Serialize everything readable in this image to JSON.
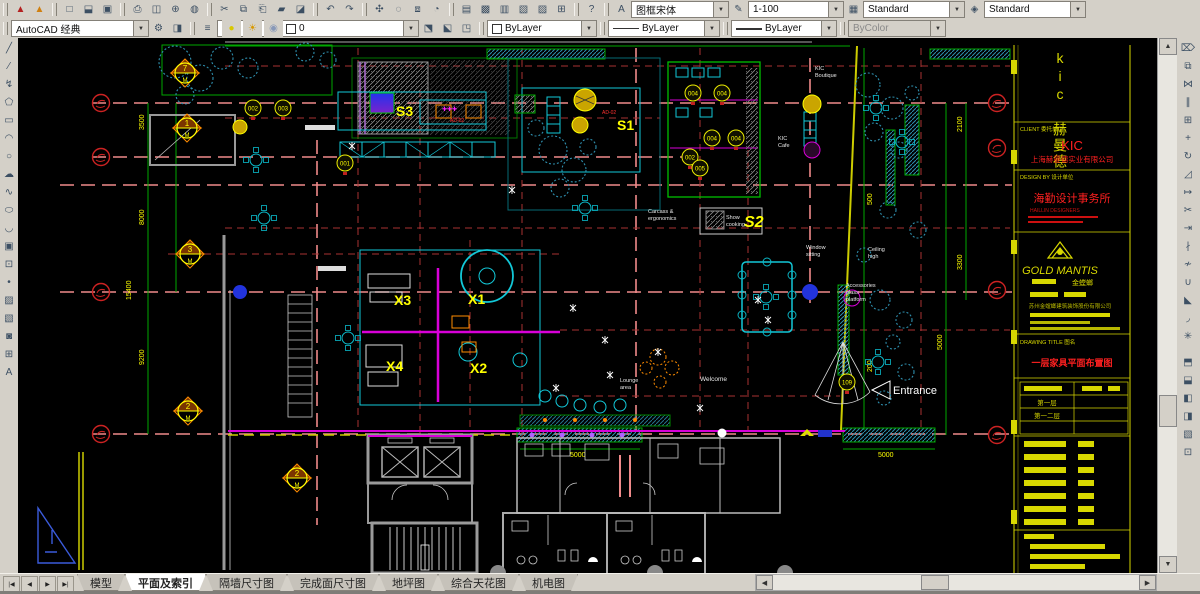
{
  "toolbars": {
    "row1_icons": [
      {
        "n": "pdf-export-icon",
        "g": "▲",
        "c": "#b42020"
      },
      {
        "n": "pdf-convert-icon",
        "g": "▲",
        "c": "#d08010"
      },
      {
        "n": "sep"
      },
      {
        "n": "new-file-icon",
        "g": "□"
      },
      {
        "n": "open-file-icon",
        "g": "⬓"
      },
      {
        "n": "save-icon",
        "g": "▣"
      },
      {
        "n": "sep"
      },
      {
        "n": "plot-icon",
        "g": "⎙"
      },
      {
        "n": "plot-preview-icon",
        "g": "◫"
      },
      {
        "n": "publish-icon",
        "g": "⊕"
      },
      {
        "n": "dwf-viewer-icon",
        "g": "◍"
      },
      {
        "n": "sep"
      },
      {
        "n": "cut-icon",
        "g": "✂"
      },
      {
        "n": "copy-clip-icon",
        "g": "⧉"
      },
      {
        "n": "paste-icon",
        "g": "⎗"
      },
      {
        "n": "match-properties-icon",
        "g": "▰"
      },
      {
        "n": "block-editor-icon",
        "g": "◪"
      },
      {
        "n": "sep"
      },
      {
        "n": "undo-icon",
        "g": "↶"
      },
      {
        "n": "redo-icon",
        "g": "↷"
      },
      {
        "n": "sep"
      },
      {
        "n": "pan-icon",
        "g": "✣"
      },
      {
        "n": "zoom-realtime-icon",
        "g": "◌"
      },
      {
        "n": "zoom-window-icon",
        "g": "⧈"
      },
      {
        "n": "zoom-previous-icon",
        "g": "◔"
      },
      {
        "n": "sep"
      },
      {
        "n": "properties-icon",
        "g": "▤"
      },
      {
        "n": "designcenter-icon",
        "g": "▩"
      },
      {
        "n": "tool-palettes-icon",
        "g": "▥"
      },
      {
        "n": "sheetset-manager-icon",
        "g": "▧"
      },
      {
        "n": "markup-icon",
        "g": "▨"
      },
      {
        "n": "quickcalc-icon",
        "g": "⊞"
      },
      {
        "n": "sep"
      },
      {
        "n": "help-icon",
        "g": "?"
      },
      {
        "n": "sep"
      },
      {
        "n": "text-style-icon",
        "g": "A"
      }
    ],
    "text_style_value": "图框宋体",
    "dim_style_icon": "✎",
    "scale_value": "1-100",
    "table_style_icon": "▦",
    "dim_style_value": "Standard",
    "mleader_icon": "◈",
    "table_style_value": "Standard",
    "workspace_value": "AutoCAD 经典",
    "workspace_icons": [
      {
        "n": "workspace-settings-icon",
        "g": "⚙"
      },
      {
        "n": "workspace-save-icon",
        "g": "◨"
      }
    ],
    "layer_properties_icon": {
      "n": "layer-properties-icon",
      "g": "≡"
    },
    "layer_state_icons": [
      {
        "n": "lightbulb-icon",
        "g": "●",
        "c": "#d8c800"
      },
      {
        "n": "sun-icon",
        "g": "☀",
        "c": "#d89800"
      },
      {
        "n": "lock-icon",
        "g": "◉",
        "c": "#8898b8"
      }
    ],
    "layer_value": "0",
    "layer_right_icons": [
      {
        "n": "make-object-layer-current-icon",
        "g": "⬔"
      },
      {
        "n": "layer-previous-icon",
        "g": "⬕"
      },
      {
        "n": "layer-states-icon",
        "g": "◳"
      }
    ],
    "color_value": "ByLayer",
    "linetype_value": "ByLayer",
    "lineweight_value": "ByLayer",
    "plotstyle_value": "ByColor",
    "draw_icons": [
      {
        "n": "line-icon",
        "g": "╱"
      },
      {
        "n": "construction-line-icon",
        "g": "⁄"
      },
      {
        "n": "polyline-icon",
        "g": "↯"
      },
      {
        "n": "polygon-icon",
        "g": "⬠"
      },
      {
        "n": "rectangle-icon",
        "g": "▭"
      },
      {
        "n": "arc-icon",
        "g": "◠"
      },
      {
        "n": "circle-icon",
        "g": "○"
      },
      {
        "n": "revision-cloud-icon",
        "g": "☁"
      },
      {
        "n": "spline-icon",
        "g": "∿"
      },
      {
        "n": "ellipse-icon",
        "g": "⬭"
      },
      {
        "n": "ellipse-arc-icon",
        "g": "◡"
      },
      {
        "n": "insert-block-icon",
        "g": "▣"
      },
      {
        "n": "make-block-icon",
        "g": "⊡"
      },
      {
        "n": "point-icon",
        "g": "•"
      },
      {
        "n": "hatch-icon",
        "g": "▨"
      },
      {
        "n": "gradient-icon",
        "g": "▧"
      },
      {
        "n": "region-icon",
        "g": "◙"
      },
      {
        "n": "table-icon",
        "g": "⊞"
      },
      {
        "n": "mtext-icon",
        "g": "A"
      }
    ],
    "modify_icons": [
      {
        "n": "erase-icon",
        "g": "⌦"
      },
      {
        "n": "copy-icon",
        "g": "⧉"
      },
      {
        "n": "mirror-icon",
        "g": "⋈"
      },
      {
        "n": "offset-icon",
        "g": "∥"
      },
      {
        "n": "array-icon",
        "g": "⊞"
      },
      {
        "n": "move-icon",
        "g": "+"
      },
      {
        "n": "rotate-icon",
        "g": "↻"
      },
      {
        "n": "scale-icon",
        "g": "◿"
      },
      {
        "n": "stretch-icon",
        "g": "↦"
      },
      {
        "n": "trim-icon",
        "g": "✂"
      },
      {
        "n": "extend-icon",
        "g": "⇥"
      },
      {
        "n": "break-at-point-icon",
        "g": "∤"
      },
      {
        "n": "break-icon",
        "g": "≁"
      },
      {
        "n": "join-icon",
        "g": "∪"
      },
      {
        "n": "chamfer-icon",
        "g": "◣"
      },
      {
        "n": "fillet-icon",
        "g": "◞"
      },
      {
        "n": "explode-icon",
        "g": "✳"
      }
    ],
    "order_icons": [
      {
        "n": "bring-to-front-icon",
        "g": "⬒"
      },
      {
        "n": "send-to-back-icon",
        "g": "⬓"
      },
      {
        "n": "bring-above-icon",
        "g": "◧"
      },
      {
        "n": "send-under-icon",
        "g": "◨"
      },
      {
        "n": "text-to-front-icon",
        "g": "▧"
      },
      {
        "n": "hatch-to-back-icon",
        "g": "⊡"
      }
    ]
  },
  "tabs": {
    "nav": [
      "|◀",
      "◀",
      "▶",
      "▶|"
    ],
    "items": [
      {
        "label": "模型",
        "active": false
      },
      {
        "label": "平面及索引",
        "active": true
      },
      {
        "label": "隔墙尺寸图",
        "active": false
      },
      {
        "label": "完成面尺寸图",
        "active": false
      },
      {
        "label": "地坪图",
        "active": false
      },
      {
        "label": "综合天花图",
        "active": false
      },
      {
        "label": "机电图",
        "active": false
      }
    ]
  },
  "plan": {
    "zones": {
      "s1": "S1",
      "s2": "S2",
      "s3": "S3",
      "x1": "X1",
      "x2": "X2",
      "x3": "X3",
      "x4": "X4"
    },
    "texts": {
      "welcome": "Welcome",
      "entrance": "Entrance",
      "kic_boutique_1": "KIC",
      "kic_boutique_2": "Boutique",
      "kic_cafe_1": "KIC",
      "kic_cafe_2": "Cafe",
      "carcass_1": "Carcass &",
      "carcass_2": "ergonomics",
      "show_1": "Show",
      "show_2": "cooking",
      "window_1": "Window",
      "window_2": "sitting",
      "ceiling_1": "Ceiling",
      "ceiling_2": "high",
      "access_1": "Accessories",
      "access_2": "glass",
      "access_3": "platform",
      "lounge_1": "Lounge",
      "lounge_2": "area",
      "ad02_a": "AD-02",
      "ad02_b": "AD-02",
      "plus": "✚✚✚"
    },
    "dims": {
      "d3500": "3500",
      "d8000": "8000",
      "d15400": "15400",
      "d9200": "9200",
      "d2100": "2100",
      "d3300": "3300",
      "d5000": "5000",
      "d500": "500",
      "d5000b": "5000",
      "d200": "200"
    },
    "markers": [
      "7",
      "1",
      "3",
      "2",
      "2"
    ],
    "bubbles": [
      "002",
      "003",
      "001",
      "004",
      "004",
      "004",
      "004",
      "002",
      "005",
      "109"
    ]
  },
  "titleblock": {
    "brand": "kic 赫曼德",
    "client_label": "CLIENT 委托单位",
    "client_name": "KIC",
    "client_co": "上海赫曼德实业有限公司",
    "design_label": "DESIGN BY 设计单位",
    "design_name": "海勤设计事务所",
    "design_en": "HAILLIN DESIGNERS",
    "logo_name": "GOLD MANTIS",
    "logo_cn": "金螳螂",
    "logo_co": "苏州金螳螂建筑装饰股份有限公司",
    "title_label": "DRAWING TITLE 图名",
    "title": "一层家具平面布置图",
    "rows": [
      "第一层",
      "第一二层"
    ]
  },
  "colors": {
    "grid_red": "#a83232",
    "grid_salmon": "#ef8a8a",
    "wall_cyan": "#12c8d8",
    "wall_magenta": "#d800d8",
    "label_yellow": "#ffff00",
    "dim_green": "#00a800",
    "tree_teal": "#2e8fae",
    "title_yellow": "#d8d800",
    "title_red": "#ff2020",
    "core_gray": "#9a9a9a"
  }
}
